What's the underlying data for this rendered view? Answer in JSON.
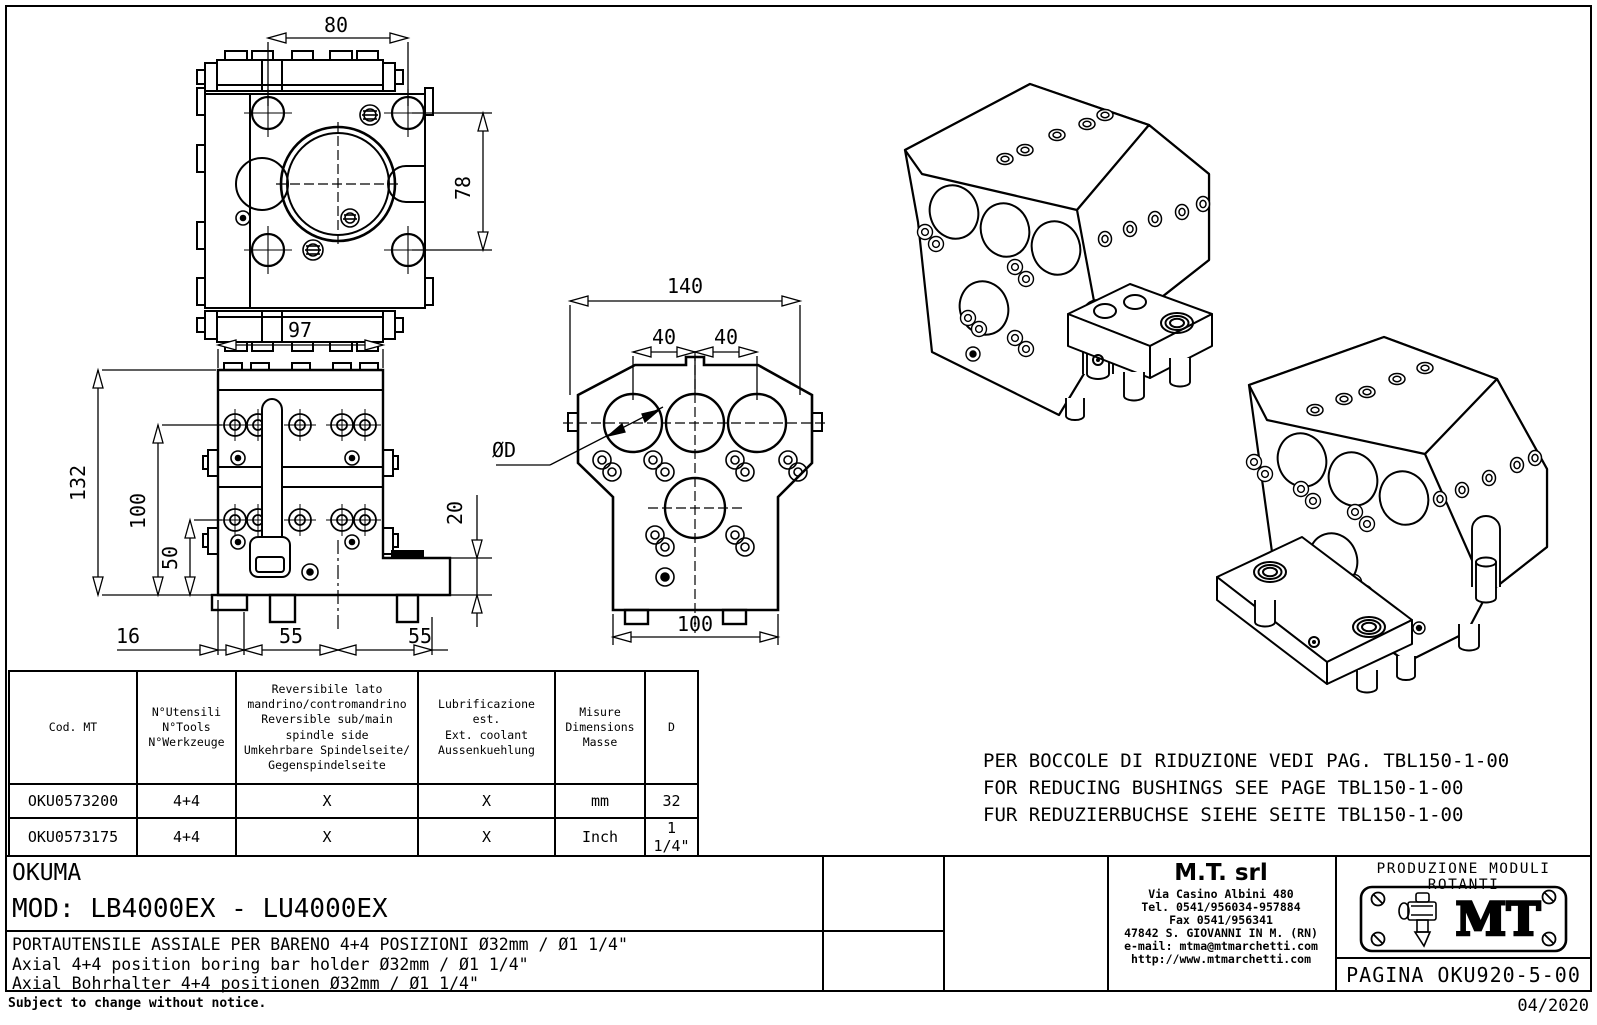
{
  "frame": {
    "footer_note": "Subject to change without notice.",
    "date": "04/2020"
  },
  "views": {
    "top": {
      "dim_width": "80",
      "dim_height": "78"
    },
    "front": {
      "dim_width": "97",
      "dim_h_total": "132",
      "dim_h_mid": "100",
      "dim_h_low": "50",
      "dim_left": "16",
      "dim_pitch_l": "55",
      "dim_pitch_r": "55",
      "dim_step": "20"
    },
    "back": {
      "dim_width": "140",
      "dim_pitch_l": "40",
      "dim_pitch_r": "40",
      "dim_bore": "ØD",
      "dim_base": "100"
    }
  },
  "notes": {
    "line_it": "PER BOCCOLE DI RIDUZIONE VEDI PAG. TBL150-1-00",
    "line_en": "FOR REDUCING BUSHINGS SEE PAGE TBL150-1-00",
    "line_de": "FUR REDUZIERBUCHSE SIEHE SEITE TBL150-1-00"
  },
  "table": {
    "headers": {
      "cod": "Cod. MT",
      "tools": "N°Utensili\nN°Tools\nN°Werkzeuge",
      "reversible": "Reversibile lato\nmandrino/contromandrino\nReversible sub/main\nspindle side\nUmkehrbare Spindelseite/\nGegenspindelseite",
      "coolant": "Lubrificazione est.\nExt. coolant\nAussenkuehlung",
      "measure": "Misure\nDimensions\nMasse",
      "d": "D"
    },
    "rows": [
      {
        "cod": "OKU0573200",
        "tools": "4+4",
        "reversible": "X",
        "coolant": "X",
        "measure": "mm",
        "d": "32"
      },
      {
        "cod": "OKU0573175",
        "tools": "4+4",
        "reversible": "X",
        "coolant": "X",
        "measure": "Inch",
        "d": "1 1/4\""
      }
    ]
  },
  "title_block": {
    "customer": "OKUMA",
    "model": "MOD: LB4000EX - LU4000EX",
    "desc_it": "PORTAUTENSILE ASSIALE PER BARENO 4+4 POSIZIONI Ø32mm / Ø1 1/4\"",
    "desc_en": "Axial 4+4 position boring bar holder Ø32mm / Ø1 1/4\"",
    "desc_de": "Axial Bohrhalter 4+4 positionen Ø32mm / Ø1 1/4\"",
    "company": {
      "name": "M.T. srl",
      "address": "Via Casino Albini 480",
      "tel": "Tel. 0541/956034-957884",
      "fax": "Fax 0541/956341",
      "city": "47842 S. GIOVANNI IN M. (RN)",
      "email": "e-mail: mtma@mtmarchetti.com",
      "web": "http://www.mtmarchetti.com"
    },
    "logo_caption": "PRODUZIONE MODULI ROTANTI",
    "logo_text": "MT",
    "page": "PAGINA OKU920-5-00"
  }
}
